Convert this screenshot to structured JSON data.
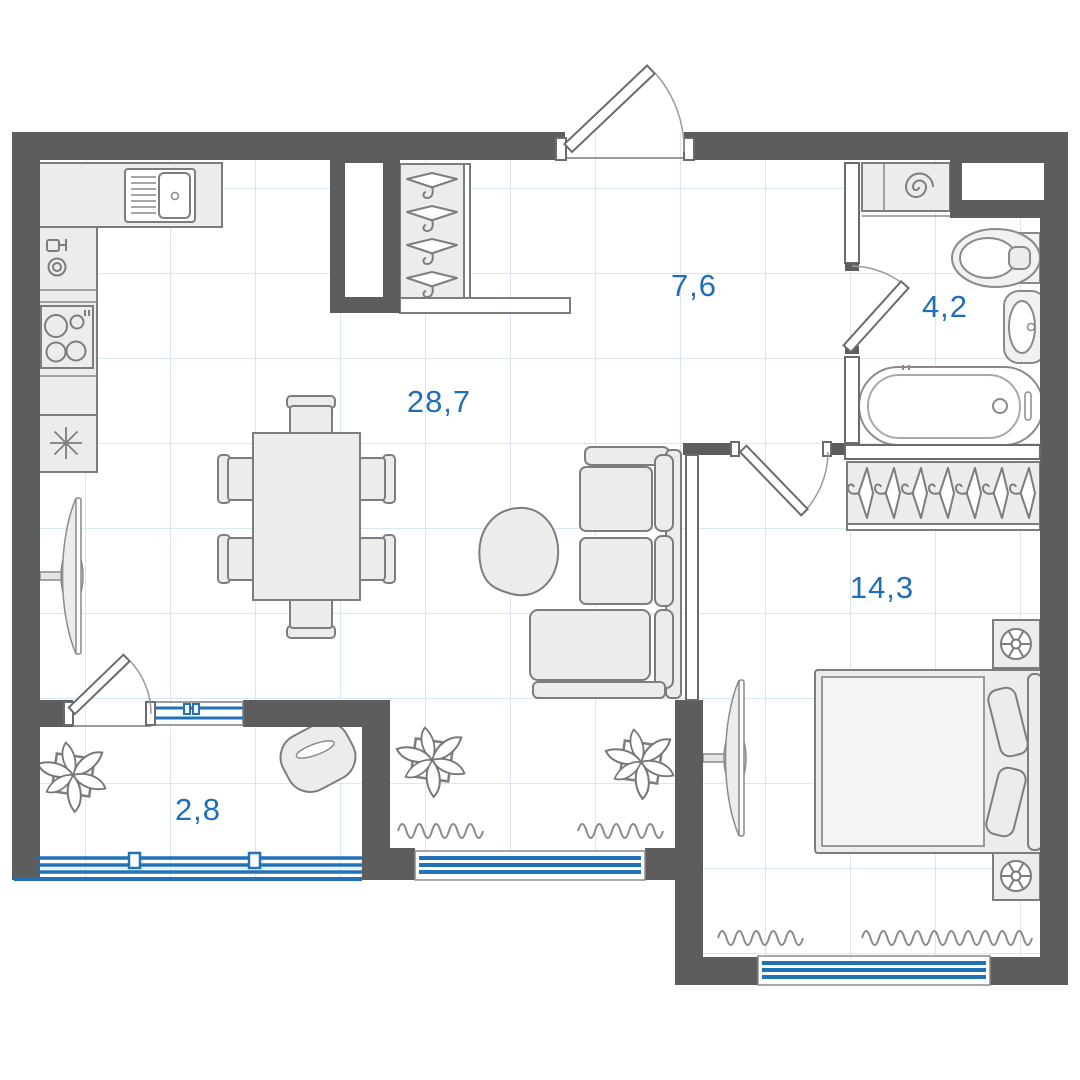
{
  "floor_plan": {
    "rooms": {
      "living_kitchen": {
        "label": "28,7"
      },
      "hallway": {
        "label": "7,6"
      },
      "bathroom": {
        "label": "4,2"
      },
      "bedroom": {
        "label": "14,3"
      },
      "balcony": {
        "label": "2,8"
      }
    },
    "colors": {
      "wall": "#5d5d5d",
      "label_blue": "#1e6fb8",
      "window_blue": "#2272b8",
      "furniture_fill": "#ECECEA",
      "furniture_outline": "#7d7d7d",
      "grid": "#d9e6f4",
      "background": "#ffffff"
    },
    "furniture_symbols": [
      "kitchen-counter",
      "kitchen-sink",
      "dishwasher",
      "stove",
      "refrigerator",
      "entry-wardrobe-hangers",
      "shoe-shelf",
      "dining-table",
      "dining-chair",
      "corner-sofa",
      "coffee-table",
      "tv",
      "potted-plant",
      "radiator",
      "bedroom-wardrobe-hangers",
      "double-bed",
      "pillow",
      "nightstand-lamp",
      "washing-machine",
      "toilet",
      "washbasin",
      "bathtub",
      "balcony-armchair",
      "balcony-glazing",
      "window",
      "door-swing"
    ]
  }
}
